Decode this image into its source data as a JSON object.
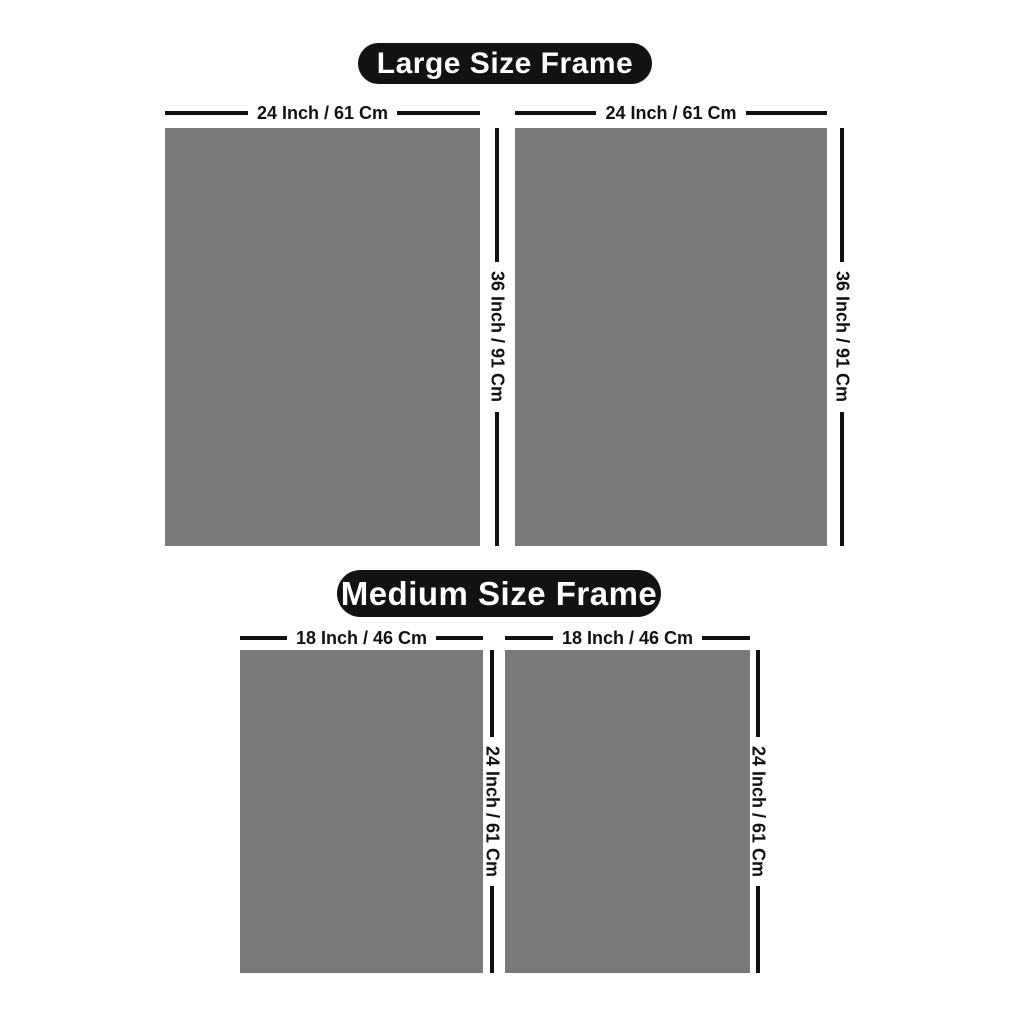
{
  "colors": {
    "frame_fill": "#797979",
    "pill_background": "#121212",
    "pill_text": "#ffffff",
    "dimension_line": "#111111",
    "dimension_text": "#111111",
    "page_background": "#ffffff"
  },
  "sections": [
    {
      "title": "Large Size Frame",
      "width_inch": 24,
      "width_cm": 61,
      "height_inch": 36,
      "height_cm": 91,
      "frames": [
        {
          "width_label": "24 Inch / 61 Cm",
          "height_label": "36 Inch / 91 Cm"
        },
        {
          "width_label": "24 Inch / 61 Cm",
          "height_label": "36 Inch / 91 Cm"
        }
      ]
    },
    {
      "title": "Medium Size Frame",
      "width_inch": 18,
      "width_cm": 46,
      "height_inch": 24,
      "height_cm": 61,
      "frames": [
        {
          "width_label": "18 Inch / 46 Cm",
          "height_label": "24 Inch / 61 Cm"
        },
        {
          "width_label": "18 Inch / 46 Cm",
          "height_label": "24 Inch / 61 Cm"
        }
      ]
    }
  ]
}
